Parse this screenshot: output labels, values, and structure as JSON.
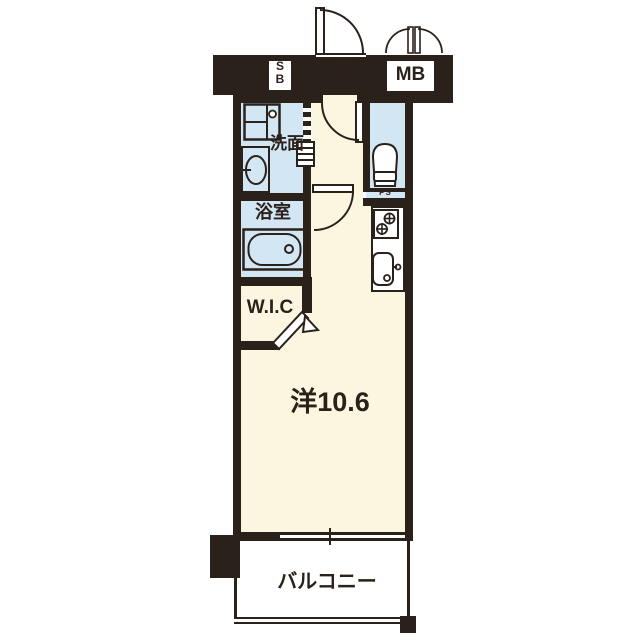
{
  "floorplan": {
    "rooms": {
      "entrance": {
        "label": "玄関"
      },
      "shoe_box": {
        "label": "S\nB"
      },
      "meter_box": {
        "label": "MB"
      },
      "washroom": {
        "label": "洗面"
      },
      "bathroom": {
        "label": "浴室"
      },
      "pipe_space": {
        "label": "PS"
      },
      "walk_in_closet": {
        "label": "W.I.C"
      },
      "western_room": {
        "label": "洋10.6"
      },
      "balcony": {
        "label": "バルコニー"
      }
    },
    "colors": {
      "wall": "#2b211b",
      "floor_cream": "#fbf6df",
      "wet_area_blue": "#d2e6f3",
      "white": "#ffffff"
    }
  }
}
